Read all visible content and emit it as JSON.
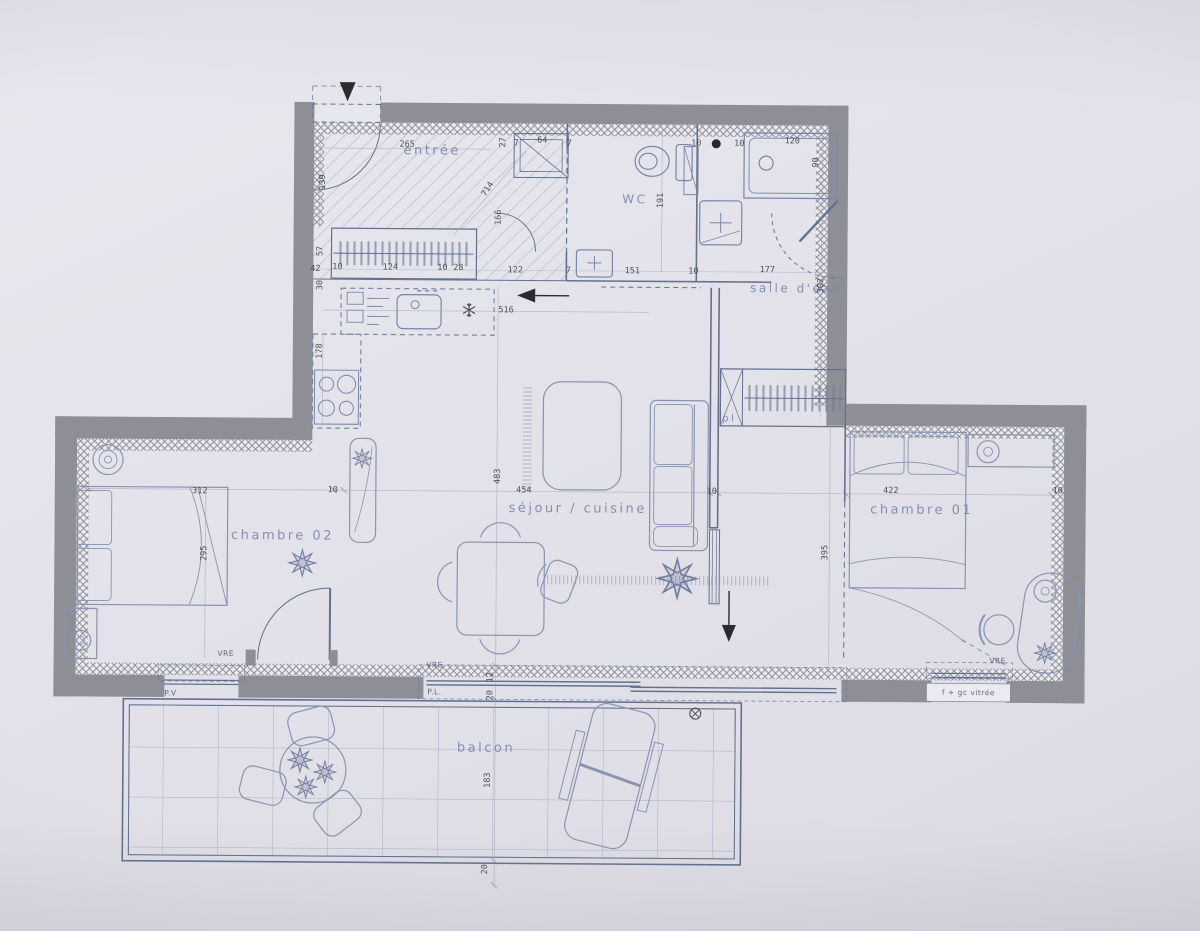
{
  "colors": {
    "paper": "#e3e2ea",
    "wall": "#8e8e96",
    "line": "#64708e",
    "furniture_line": "#8a93b0",
    "dim_text": "#3d3d47",
    "room_text": "#7e86a8",
    "arrow": "#2a2a2e"
  },
  "rooms": [
    {
      "t": "entrée",
      "x": 430,
      "y": 152,
      "fs": 13
    },
    {
      "t": "WC",
      "x": 633,
      "y": 199,
      "fs": 12
    },
    {
      "t": "salle d'eau",
      "x": 795,
      "y": 287,
      "fs": 12
    },
    {
      "t": "séjour / cuisine",
      "x": 578,
      "y": 509,
      "fs": 13
    },
    {
      "t": "chambre 02",
      "x": 283,
      "y": 538,
      "fs": 13
    },
    {
      "t": "chambre 01",
      "x": 922,
      "y": 508,
      "fs": 13
    },
    {
      "t": "balcon",
      "x": 488,
      "y": 749,
      "fs": 13
    },
    {
      "t": "pl",
      "x": 729,
      "y": 418,
      "fs": 10
    }
  ],
  "dims": [
    {
      "t": "265",
      "x": 405,
      "y": 146,
      "r": 0
    },
    {
      "t": "139",
      "x": 321,
      "y": 184,
      "r": -90
    },
    {
      "t": "714",
      "x": 486,
      "y": 190,
      "r": -58
    },
    {
      "t": "166",
      "x": 497,
      "y": 218,
      "r": -90
    },
    {
      "t": "27",
      "x": 501,
      "y": 143,
      "r": -90
    },
    {
      "t": "7",
      "x": 514,
      "y": 144,
      "r": 0
    },
    {
      "t": "64",
      "x": 540,
      "y": 141,
      "r": 0
    },
    {
      "t": "7",
      "x": 567,
      "y": 144,
      "r": 0
    },
    {
      "t": "42",
      "x": 314,
      "y": 271,
      "r": 0
    },
    {
      "t": "10",
      "x": 336,
      "y": 269,
      "r": 0
    },
    {
      "t": "124",
      "x": 389,
      "y": 269,
      "r": 0
    },
    {
      "t": "10",
      "x": 441,
      "y": 269,
      "r": 0
    },
    {
      "t": "28",
      "x": 457,
      "y": 269,
      "r": 0
    },
    {
      "t": "122",
      "x": 514,
      "y": 271,
      "r": 0
    },
    {
      "t": "7",
      "x": 567,
      "y": 271,
      "r": 0
    },
    {
      "t": "151",
      "x": 631,
      "y": 271,
      "r": 0
    },
    {
      "t": "10",
      "x": 692,
      "y": 271,
      "r": 0
    },
    {
      "t": "177",
      "x": 766,
      "y": 269,
      "r": 0
    },
    {
      "t": "10",
      "x": 694,
      "y": 143,
      "r": 0
    },
    {
      "t": "10",
      "x": 737,
      "y": 143,
      "r": 0
    },
    {
      "t": "120",
      "x": 790,
      "y": 140,
      "r": 0
    },
    {
      "t": "90",
      "x": 814,
      "y": 161,
      "r": -90
    },
    {
      "t": "191",
      "x": 659,
      "y": 200,
      "r": -90
    },
    {
      "t": "302",
      "x": 820,
      "y": 284,
      "r": -90
    },
    {
      "t": "516",
      "x": 505,
      "y": 311,
      "r": 0
    },
    {
      "t": "178",
      "x": 319,
      "y": 353,
      "r": -90
    },
    {
      "t": "57",
      "x": 319,
      "y": 253,
      "r": -90
    },
    {
      "t": "30",
      "x": 319,
      "y": 287,
      "r": -90
    },
    {
      "t": "483",
      "x": 498,
      "y": 477,
      "r": -90
    },
    {
      "t": "454",
      "x": 524,
      "y": 491,
      "r": 0
    },
    {
      "t": "10",
      "x": 712,
      "y": 491,
      "r": 0
    },
    {
      "t": "312",
      "x": 200,
      "y": 494,
      "r": 0
    },
    {
      "t": "10",
      "x": 333,
      "y": 492,
      "r": 0
    },
    {
      "t": "295",
      "x": 205,
      "y": 556,
      "r": -90
    },
    {
      "t": "422",
      "x": 891,
      "y": 489,
      "r": 0
    },
    {
      "t": "10",
      "x": 1058,
      "y": 488,
      "r": 0
    },
    {
      "t": "395",
      "x": 826,
      "y": 551,
      "r": -90
    },
    {
      "t": "183",
      "x": 490,
      "y": 781,
      "r": -90
    },
    {
      "t": "12",
      "x": 492,
      "y": 678,
      "r": -90
    },
    {
      "t": "20",
      "x": 492,
      "y": 696,
      "r": -90
    },
    {
      "t": "20",
      "x": 488,
      "y": 870,
      "r": -90
    }
  ],
  "window_labels": [
    {
      "t": "VRE",
      "x": 227,
      "y": 656
    },
    {
      "t": "VRE",
      "x": 436,
      "y": 666
    },
    {
      "t": "P.L.",
      "x": 436,
      "y": 693
    },
    {
      "t": "P.V",
      "x": 172,
      "y": 696
    },
    {
      "t": "VRE",
      "x": 999,
      "y": 658
    },
    {
      "t": "f + gc vitrée",
      "x": 970,
      "y": 690
    }
  ]
}
